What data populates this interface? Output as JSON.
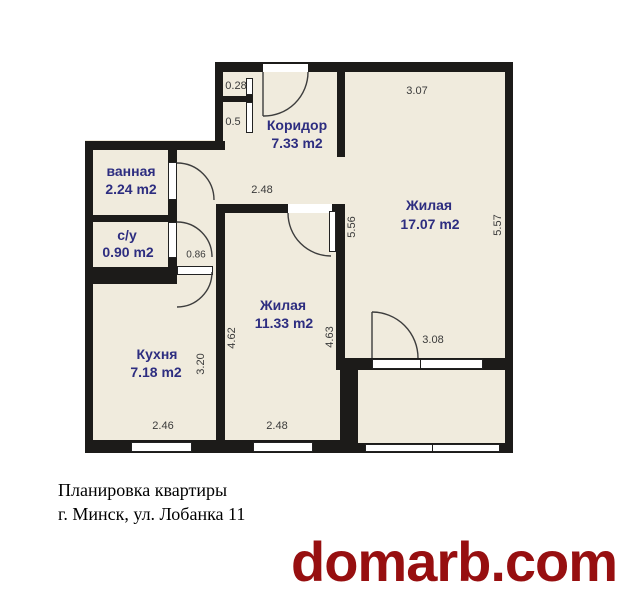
{
  "plan": {
    "rooms": [
      {
        "id": "koridor",
        "name": "Коридор",
        "area": "7.33 m2"
      },
      {
        "id": "vannaya",
        "name": "ванная",
        "area": "2.24 m2"
      },
      {
        "id": "su",
        "name": "с/у",
        "area": "0.90 m2"
      },
      {
        "id": "kuhnya",
        "name": "Кухня",
        "area": "7.18 m2"
      },
      {
        "id": "zhilaya1",
        "name": "Жилая",
        "area": "11.33 m2"
      },
      {
        "id": "zhilaya2",
        "name": "Жилая",
        "area": "17.07 m2"
      }
    ],
    "dimensions": {
      "closet_top": "0.28",
      "closet_bottom": "0.5",
      "room2_top": "3.07",
      "room1_top": "2.48",
      "passage": "0.86",
      "room2_left": "5.56",
      "room2_right": "5.57",
      "room1_left": "4.62",
      "room1_right": "4.63",
      "kitchen_right": "3.20",
      "balcony_door": "3.08",
      "kitchen_bottom": "2.46",
      "room1_bottom": "2.48"
    },
    "colors": {
      "room_fill": "#f0ebdd",
      "wall": "#1c1b19",
      "room_label": "#2d2d80",
      "dim_label": "#3a3a3a"
    }
  },
  "footer": {
    "title_line1": "Планировка квартиры",
    "title_line2": "г. Минск, ул. Лобанка 11"
  },
  "watermark": {
    "text": "domarb.com",
    "color": "#970f10"
  }
}
